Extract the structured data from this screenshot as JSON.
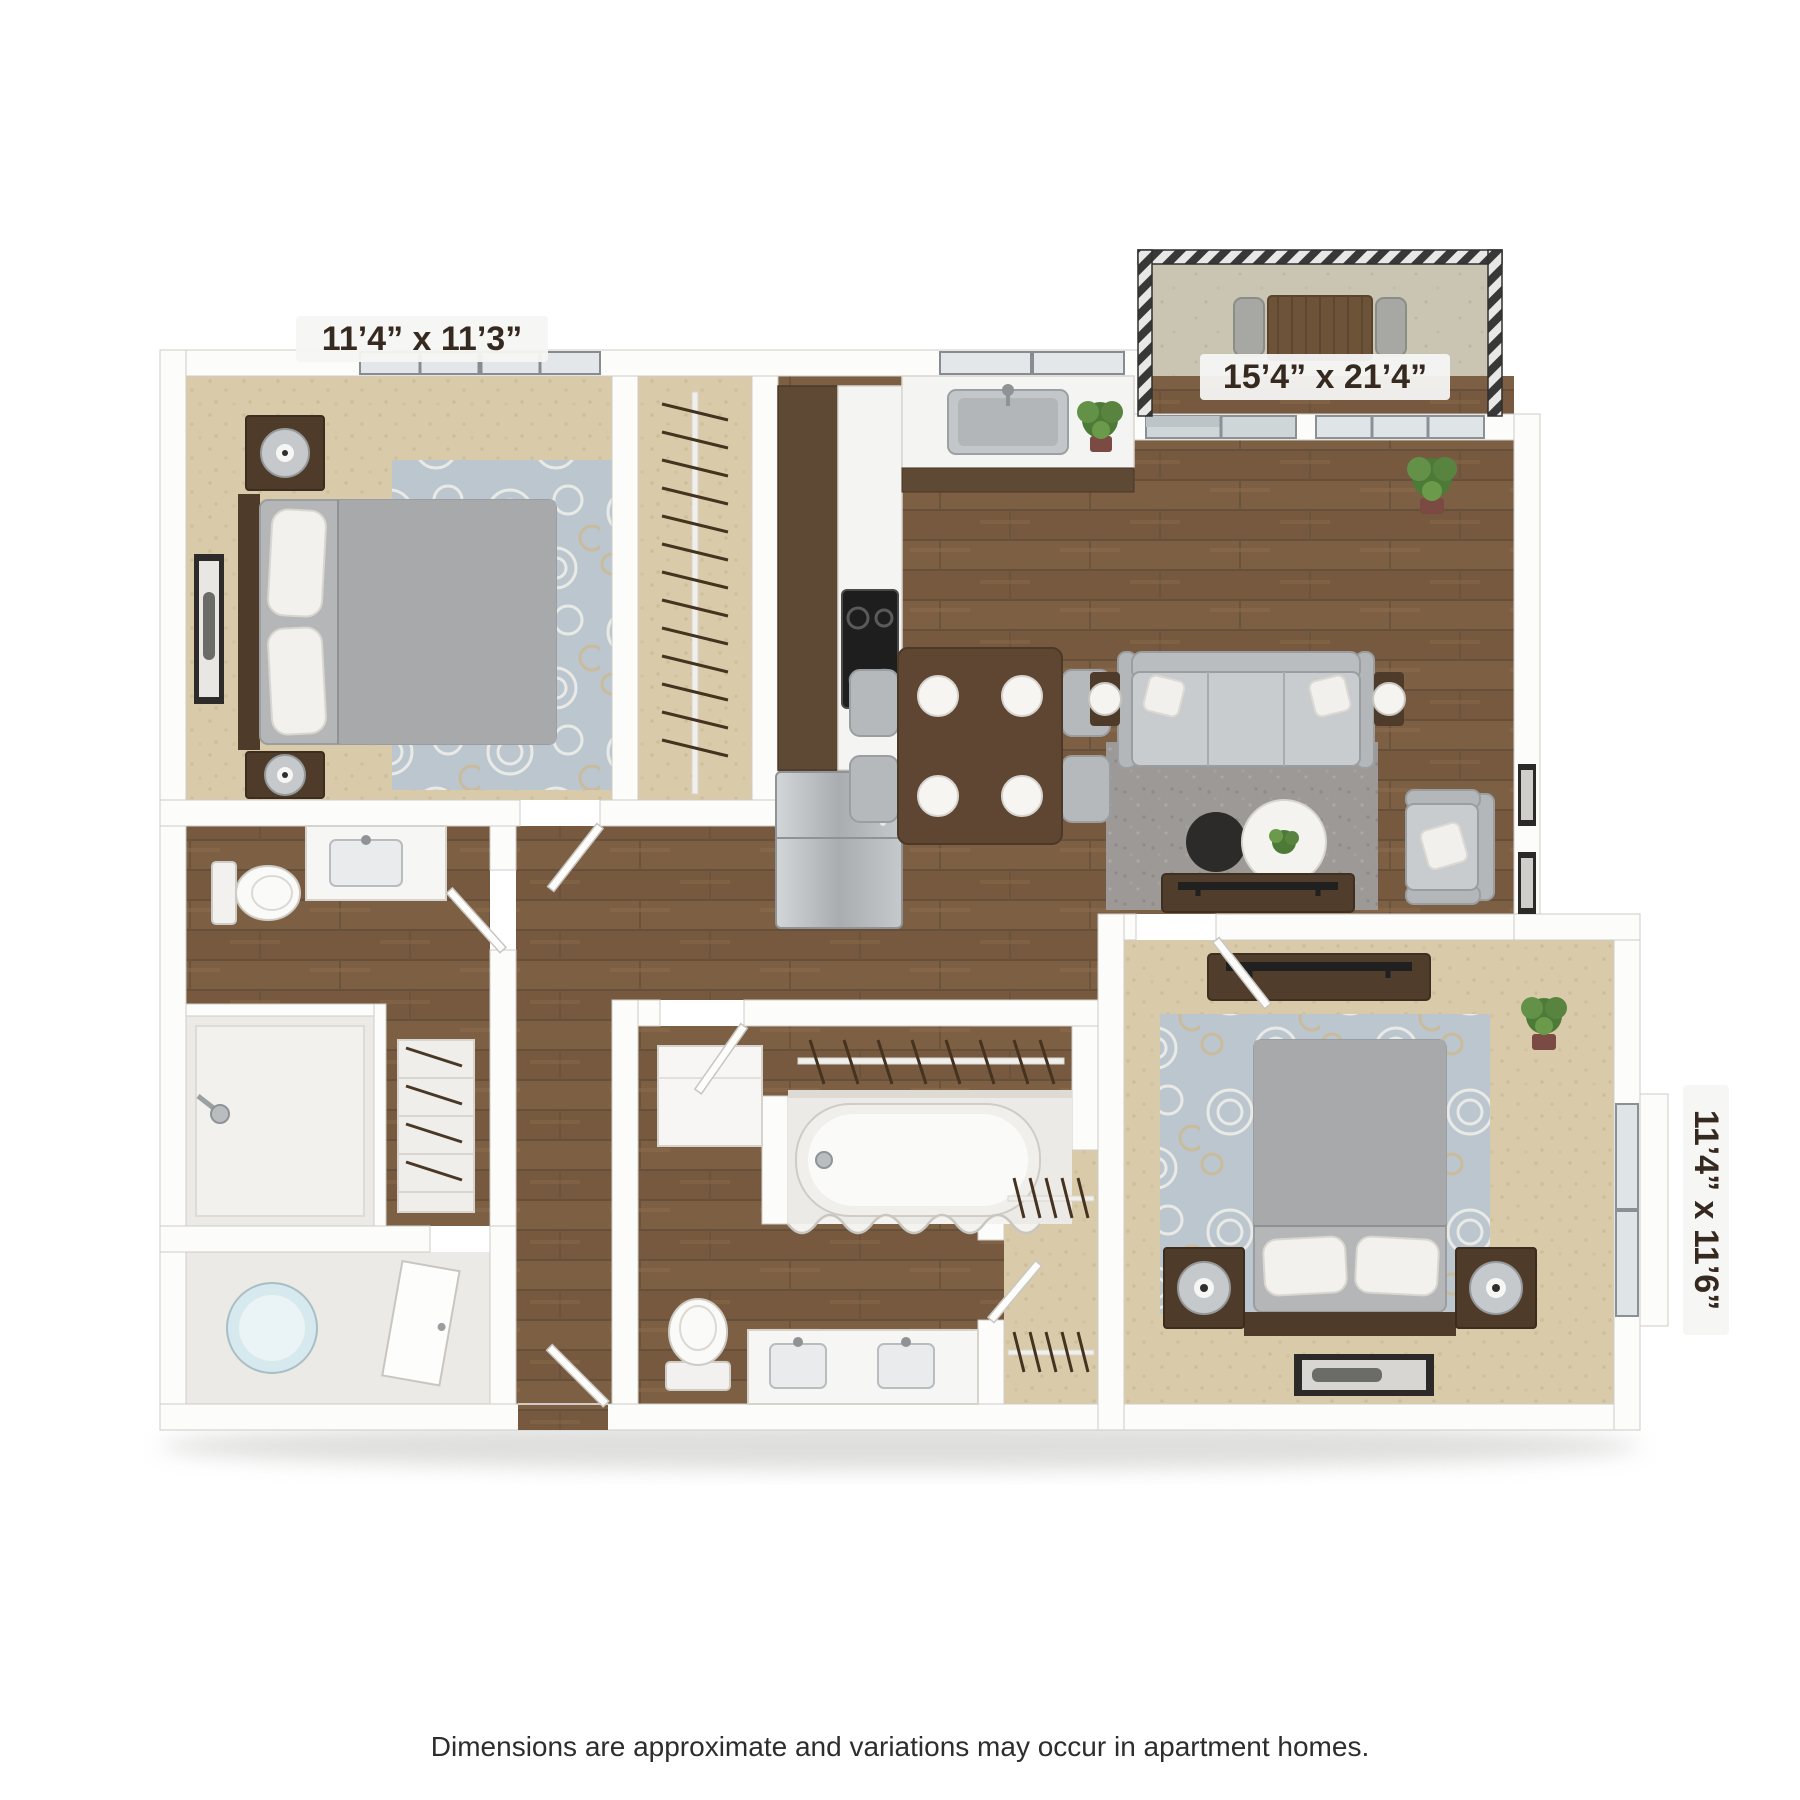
{
  "page": {
    "background_color": "#ffffff",
    "disclaimer": "Dimensions are approximate and variations may occur in apartment homes."
  },
  "floor_plan": {
    "title": "3D top-view apartment floor plan, 2 bedroom / 2 bath with balcony",
    "room_labels": {
      "bedroom_1": "11’4” x 11’3”",
      "living_area": "15’4” x 21’4”",
      "bedroom_2": "11’4” x 11’6”"
    },
    "rooms": [
      {
        "name": "bedroom-1",
        "dimensions": "11’4” x 11’3”",
        "features": [
          "bed",
          "two nightstands with lamps",
          "area rug",
          "wall art",
          "window",
          "reach-in closet"
        ]
      },
      {
        "name": "kitchen",
        "features": [
          "L-shaped counter",
          "sink under window",
          "cooktop",
          "refrigerator",
          "potted plant"
        ]
      },
      {
        "name": "dining-area",
        "features": [
          "table with four place settings",
          "four chairs"
        ]
      },
      {
        "name": "living-room",
        "dimensions": "15’4” x 21’4”",
        "features": [
          "sofa",
          "armchair",
          "round coffee tables",
          "gray rug",
          "tv console",
          "wall frames",
          "plants",
          "balcony access"
        ]
      },
      {
        "name": "balcony",
        "features": [
          "railing",
          "outdoor table",
          "two chairs"
        ]
      },
      {
        "name": "bathroom-1",
        "features": [
          "vanity sink",
          "toilet",
          "walk-in shower",
          "linen shelves"
        ]
      },
      {
        "name": "utility-room",
        "features": [
          "water heater"
        ]
      },
      {
        "name": "bathroom-2",
        "features": [
          "bathtub with curtain",
          "toilet",
          "double vanity",
          "linen rod"
        ]
      },
      {
        "name": "walk-in-closet",
        "features": [
          "hanging rods"
        ]
      },
      {
        "name": "bedroom-2",
        "dimensions": "11’4” x 11’6”",
        "features": [
          "bed",
          "two nightstands with lamps",
          "area rug",
          "tv console",
          "window",
          "plant",
          "floor art"
        ]
      }
    ],
    "colors": {
      "wall": "#fcfcfb",
      "wall_edge": "#cfccc7",
      "wood_floor": "#7d5f43",
      "carpet": "#d9cbaa",
      "tile": "#eceae6",
      "rug_floral": "#bcc6ce",
      "rug_gray": "#9d9996",
      "balcony_concrete": "#c9c5b2",
      "cabinet_wood": "#5e4935",
      "counter": "#f4f4f2",
      "stainless": "#aaaeb1",
      "upholstery_gray": "#c9ccce",
      "plant_green": "#55823f",
      "label_bg": "#f5f5f4",
      "label_text": "#36291f"
    }
  }
}
